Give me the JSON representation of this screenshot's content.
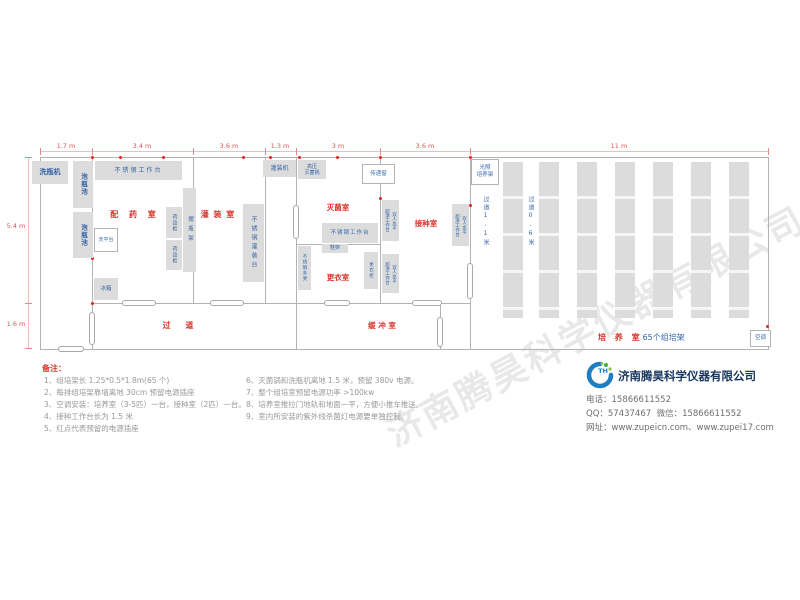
{
  "watermark": {
    "text": "济南腾昊科学仪器有限公司"
  },
  "colors": {
    "room_label": "#d9342b",
    "equipment_label": "#3465a8",
    "dimension": "#e05555",
    "company_name": "#17365d",
    "outlet_dot": "#e0261e",
    "equipment_fill": "#dcdcdc"
  },
  "plan": {
    "dim_top": [
      "1.7 m",
      "3.4 m",
      "3.6 m",
      "1.3 m",
      "3 m",
      "3.6 m",
      "11 m"
    ],
    "dim_left": [
      "5.4 m",
      "1.6 m"
    ],
    "rooms": {
      "prep": "配 药 室",
      "filling": "灌 装 室",
      "sterilization": "灭菌室",
      "changing": "更衣室",
      "inoculation": "接种室",
      "corridor": "过    道",
      "buffer": "缓 冲 室",
      "culture": "培 养 室",
      "culture_suffix": "65个组培架"
    },
    "equipment": {
      "bottle_washer": "洗瓶机",
      "soak_pool": "泡瓶池",
      "ss_worktable": "不锈钢工作台",
      "balance_table": "天平台",
      "fridge": "冰箱",
      "medicine_cabinet": "药品柜",
      "bottle_rack": "摆瓶架",
      "filling_machine": "灌装机",
      "ss_filling_table": "不锈钢灌装台",
      "autoclave_l1": "高压",
      "autoclave_l2": "灭菌锅",
      "pass_window": "传递窗",
      "ss_bench": "不锈钢条凳",
      "shoe_rack": "鞋架",
      "wardrobe": "更衣柜",
      "clean_bench_col1": "双人水平",
      "clean_bench_col2": "超净工作台",
      "light_rack_l1": "光照",
      "light_rack_l2": "培养架",
      "air_conditioner": "空调"
    },
    "aisles": {
      "a1": "过道1.1米",
      "a2": "过道0.6米"
    }
  },
  "notes": {
    "title": "备注：",
    "left": [
      "1、组培架长 1.25*0.5*1.8m(65 个)",
      "2、每排组培架靠墙离地 30cm 预留电源插座",
      "3、空调安装：培养室（3-5匹）一台，接种室（2匹）一台。",
      "4、接种工作台长为 1.5 米",
      "5、红点代表预留的电源插座"
    ],
    "right": [
      "6、灭菌锅和洗瓶机离地 1.5 米，预留 380v 电源。",
      "7、整个组培室预留电源功率 >100kw",
      "8、培养室推拉门地轨和地面一平，方便小推车推送。",
      "9、室内所安装的紫外线杀菌灯电源要单独控制。"
    ]
  },
  "company": {
    "logo_text": "TH",
    "name": "济南腾昊科学仪器有限公司",
    "tel_label": "电话：",
    "tel": "15866611552",
    "qq_label": "QQ：",
    "qq": "57437467",
    "wechat_label": "微信：",
    "wechat": "15866611552",
    "web_label": "网址：",
    "web": "www.zupeicn.com、www.zupei17.com"
  }
}
